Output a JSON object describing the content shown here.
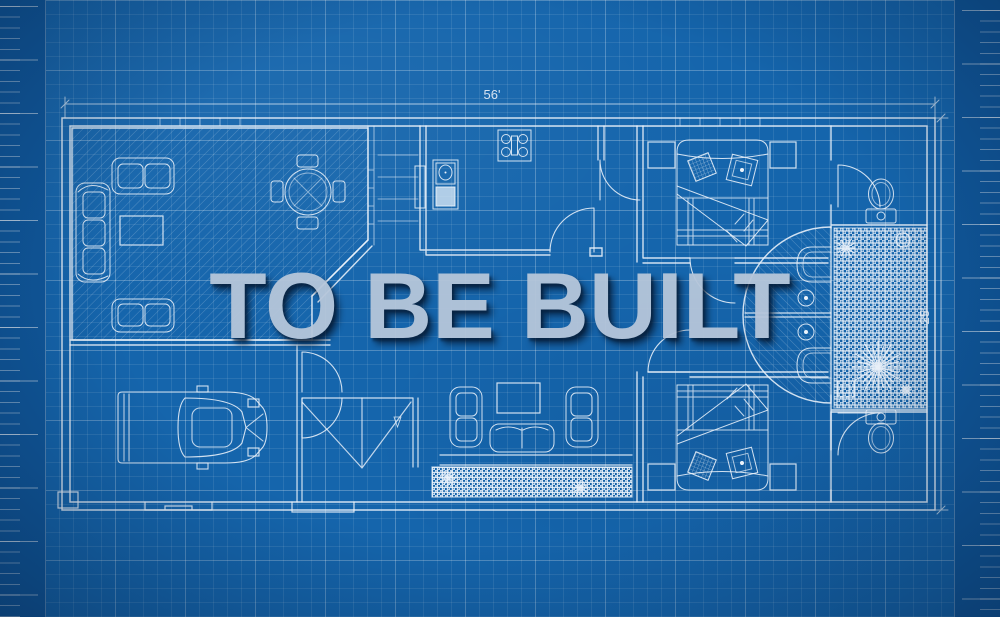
{
  "watermark": {
    "text": "TO BE BUILT"
  },
  "dimensions": {
    "width_label": "56'",
    "height_label": "25'"
  },
  "palette": {
    "paper_blue": "#1565ac",
    "margin_blue": "#10589c",
    "plan_line": "#ecf3fb",
    "grid_line": "#ffffff",
    "watermark_fill": "#b6c6da",
    "watermark_shadow": "#061830",
    "counter_fill": "#d6e6f5"
  }
}
